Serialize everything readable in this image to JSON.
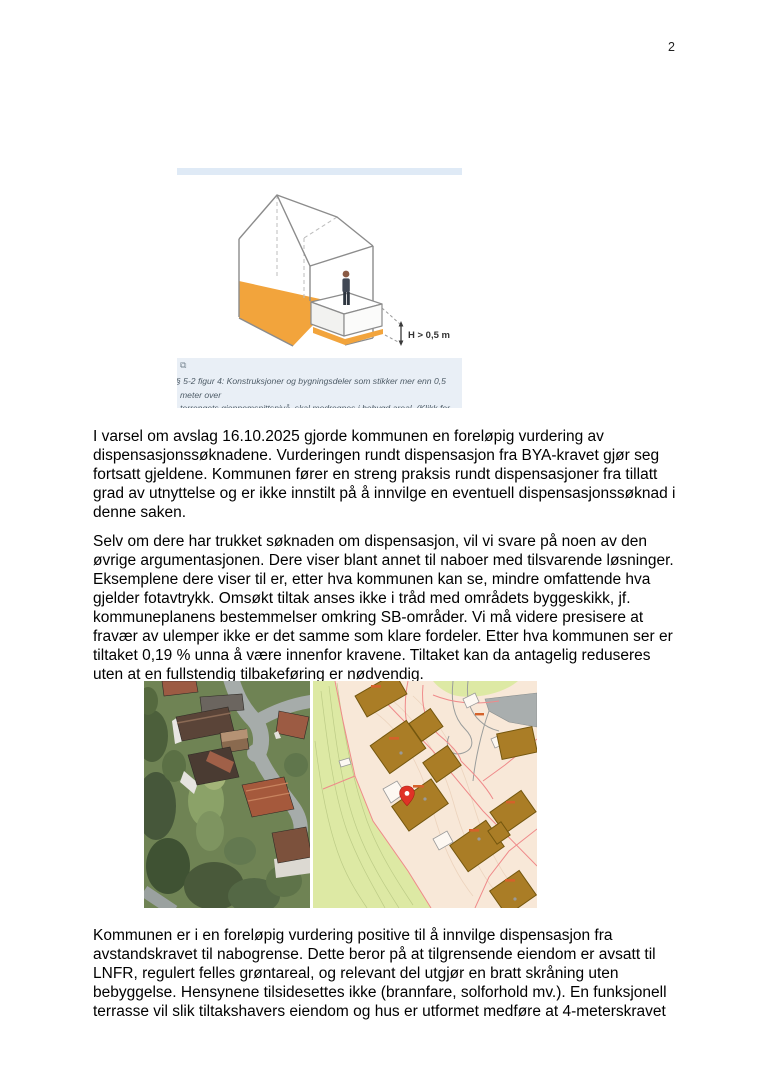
{
  "page": {
    "number": "2"
  },
  "figure": {
    "expand_icon": "⧉",
    "measurement_label": "H > 0,5 m",
    "caption": "§ 5-2 figur 4: Konstruksjoner og bygningsdeler som stikker mer enn 0,5 meter over\nterrengets gjennomsnittsnivå, skal medregnes i bebygd areal. (Klikk for større bilde.)"
  },
  "body": {
    "paragraph1": "I varsel om avslag 16.10.2025 gjorde kommunen en foreløpig vurdering av\ndispensasjonssøknadene. Vurderingen rundt dispensasjon fra BYA-kravet gjør seg\nfortsatt gjeldene. Kommunen fører en streng praksis rundt dispensasjoner fra tillatt\ngrad av utnyttelse og er ikke innstilt på å innvilge en eventuell dispensasjonssøknad i\ndenne saken.",
    "paragraph2": "Selv om dere har trukket søknaden om dispensasjon, vil vi svare på noen av den\nøvrige argumentasjonen. Dere viser blant annet til naboer med tilsvarende løsninger.\nEksemplene dere viser til er, etter hva kommunen kan se, mindre omfattende hva\ngjelder fotavtrykk. Omsøkt tiltak anses ikke i tråd med områdets byggeskikk, jf.\nkommuneplanens bestemmelser omkring SB-områder. Vi må videre presisere at\nfravær av ulemper ikke er det samme som klare fordeler. Etter hva kommunen ser er\ntiltaket 0,19 % unna å være innenfor kravene. Tiltaket kan da antagelig reduseres\nuten at en fullstendig tilbakeføring er nødvendig.",
    "paragraph3": "Kommunen er i en foreløpig vurdering positive til å innvilge dispensasjon fra\navstandskravet til nabogrense. Dette beror på at tilgrensende eiendom er avsatt til\nLNFR, regulert felles grøntareal, og relevant del utgjør en bratt skråning uten\nbebyggelse. Hensynene tilsidesettes ikke (brannfare, solforhold mv.). En funksjonell\nterrasse vil slik tiltakshavers eiendom og hus er utformet medføre at 4-meterskravet"
  },
  "colors": {
    "figure_floor_orange": "#f2a43c",
    "figure_topbar_blue": "#dfeaf6",
    "caption_bg": "#e9eff6",
    "map_building": "#aa7d26",
    "map_background": "#f8e8d8",
    "map_green": "#dde9a4",
    "map_parcel_line": "#ef8a8a",
    "map_pin_red": "#e03226"
  }
}
